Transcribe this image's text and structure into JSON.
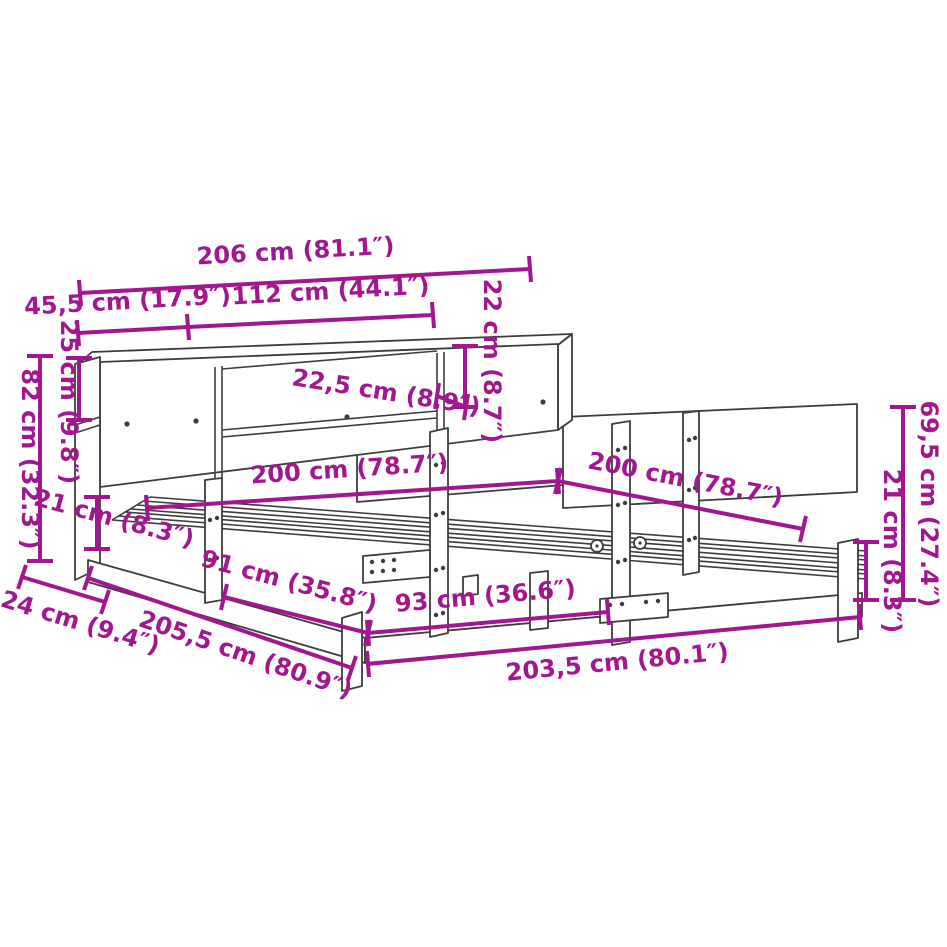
{
  "figure": {
    "product": "Bed frame with bookcase headboard — dimension diagram",
    "unit_system": "cm (inches)",
    "colors": {
      "dimension_color": "#A21690",
      "line_color": "#3D3D3D",
      "background": "#FFFFFF"
    },
    "dimensions": [
      {
        "id": "bookcase-width",
        "label": "206 cm (81.1″)"
      },
      {
        "id": "left-section-width",
        "label": "45,5 cm (17.9″)"
      },
      {
        "id": "middle-section-width",
        "label": "112 cm (44.1″)"
      },
      {
        "id": "shelf-opening-height",
        "label": "22 cm (8.7″)"
      },
      {
        "id": "top-shelf-height",
        "label": "25 cm (9.8″)"
      },
      {
        "id": "headboard-total-height",
        "label": "82 cm (32.3″)"
      },
      {
        "id": "shelf-depth",
        "label": "22,5 cm (8.9″)"
      },
      {
        "id": "mattress-width",
        "label": "200 cm (78.7″)"
      },
      {
        "id": "mattress-length",
        "label": "200 cm (78.7″)"
      },
      {
        "id": "left-frame-height",
        "label": "21 cm (8.3″)"
      },
      {
        "id": "right-leg-height",
        "label": "21 cm (8.3″)"
      },
      {
        "id": "headboard-panel-height",
        "label": "69,5 cm (27.4″)"
      },
      {
        "id": "bookcase-depth",
        "label": "24 cm (9.4″)"
      },
      {
        "id": "total-length",
        "label": "205,5 cm (80.9″)"
      },
      {
        "id": "leg-spacing-front",
        "label": "91 cm (35.8″)"
      },
      {
        "id": "leg-spacing-side",
        "label": "93 cm (36.6″)"
      },
      {
        "id": "frame-length",
        "label": "203,5 cm (80.1″)"
      }
    ]
  }
}
